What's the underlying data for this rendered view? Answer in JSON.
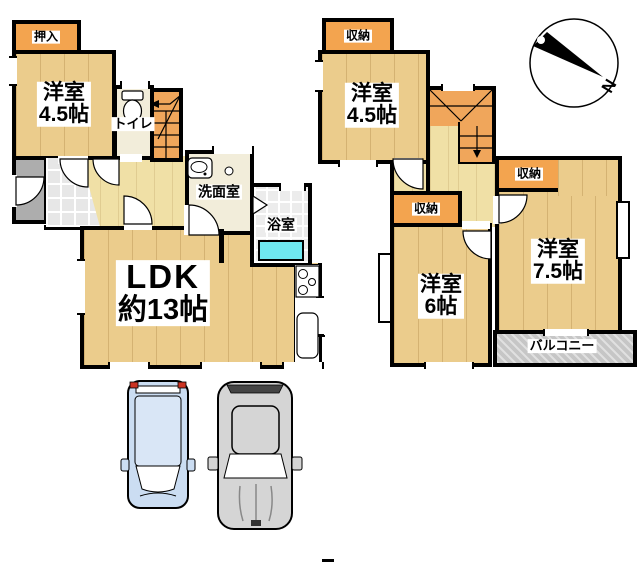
{
  "colors": {
    "wall": "#000000",
    "room_wood": "#EBCC8C",
    "hall_wood": "#F0E0A6",
    "closet_orange": "#F3A44F",
    "stairs_orange": "#F0A65B",
    "entrance_gray": "#ADADAD",
    "washroom_cream": "#F2EDDA",
    "bathtub_cyan": "#6FE8F0",
    "balcony_gray": "#C6C6C6",
    "car_blue": "#CBDDF2",
    "car_gray": "#D5D5D5",
    "taillight_red": "#CC3322"
  },
  "floor1": {
    "rooms": {
      "oshiire": {
        "label": "押入"
      },
      "yoshitsu45": {
        "line1": "洋室",
        "line2": "4.5帖"
      },
      "toilet": {
        "label": "トイレ"
      },
      "senmen": {
        "label": "洗面室"
      },
      "bath": {
        "label": "浴室"
      },
      "ldk": {
        "line1": "LDK",
        "line2": "約13帖"
      }
    }
  },
  "floor2": {
    "rooms": {
      "storage_top": {
        "label": "収納"
      },
      "yoshitsu45": {
        "line1": "洋室",
        "line2": "4.5帖"
      },
      "storage_mid": {
        "label": "収納"
      },
      "storage_right": {
        "label": "収納"
      },
      "yoshitsu6": {
        "line1": "洋室",
        "line2": "6帖"
      },
      "yoshitsu75": {
        "line1": "洋室",
        "line2": "7.5帖"
      },
      "balcony": {
        "label": "バルコニー"
      }
    }
  },
  "compass": {
    "label": "N"
  }
}
